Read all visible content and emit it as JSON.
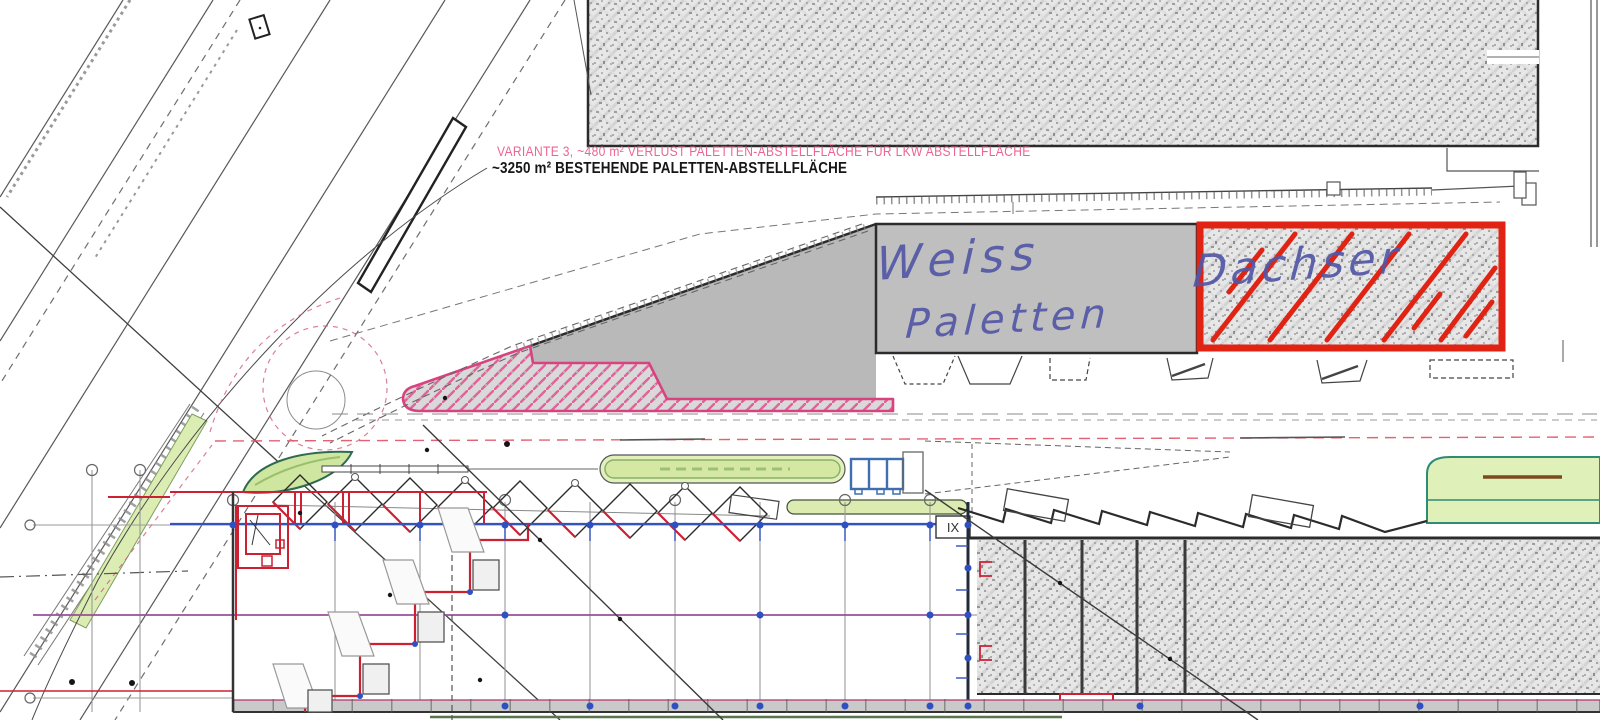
{
  "annotations": {
    "variant_note": "VARIANTE 3, ~480 m² VERLUST PALETTEN-ABSTELLFLÄCHE FÜR LKW ABSTELLFLÄCHE",
    "existing_note": "~3250 m² BESTEHENDE PALETTEN-ABSTELLFLÄCHE"
  },
  "handwriting": {
    "gray_area_line1": "Weiss",
    "gray_area_line2": "Paletten",
    "red_area": "Dachser"
  },
  "labels": {
    "grid_cell": "IX"
  },
  "colors": {
    "note_pink": "#ec6590",
    "note_black": "#161616",
    "handwriting_blue": "#5257a6",
    "highlight_red": "#e02313",
    "hatch_pink_outline": "#d8437f",
    "hatch_pink_line": "#e0639a",
    "area_gray": "#bfbfbf",
    "landscape_green_fill": "#dcedb4",
    "landscape_green_edge": "#2e8b74",
    "wall_red": "#cc2033",
    "grid_blue": "#3050c0",
    "purple_axis": "#9a4f9a",
    "truck_blue": "#3f6fae",
    "brown_mark": "#7a4a1e"
  }
}
